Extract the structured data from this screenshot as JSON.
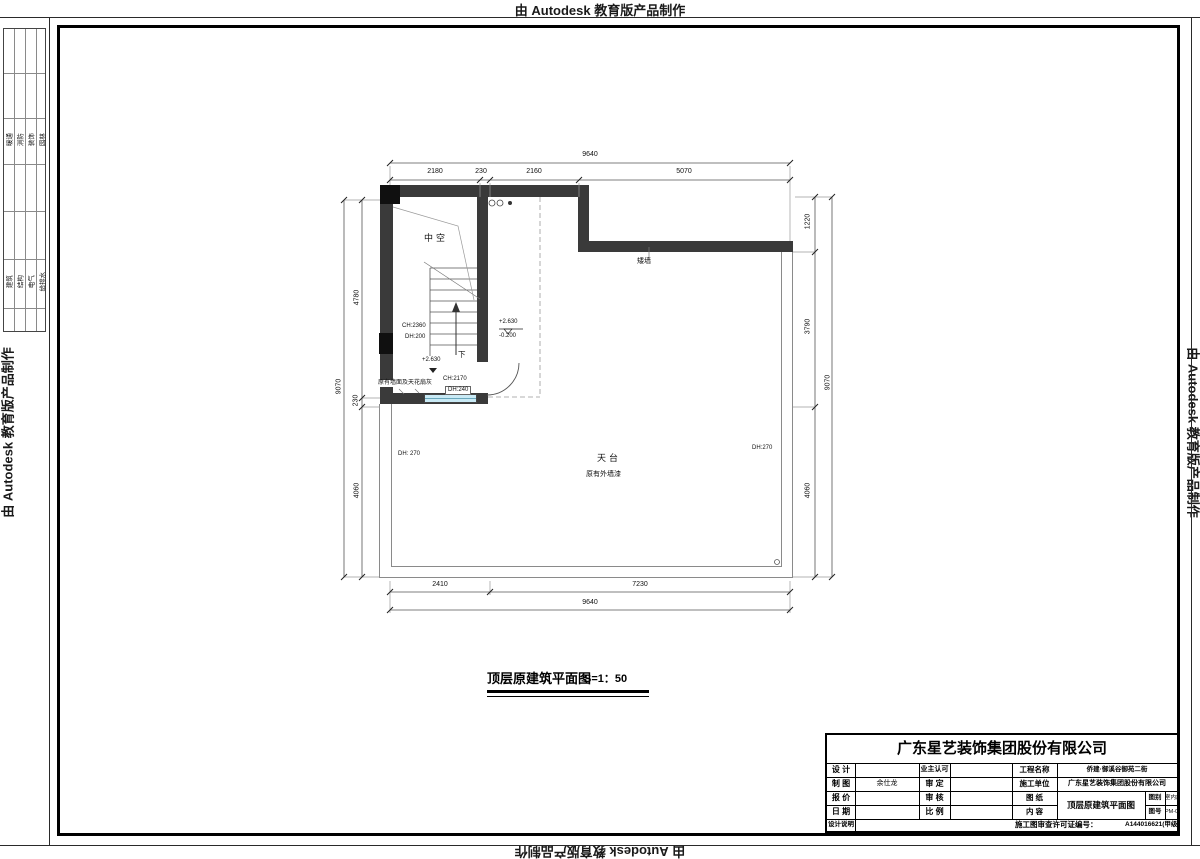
{
  "banner": {
    "text": "由 Autodesk 教育版产品制作"
  },
  "margin_table": {
    "band1": [
      "暖通",
      "消防",
      "装饰",
      "园林"
    ],
    "band2": [
      "建筑",
      "结构",
      "电气",
      "给排水"
    ]
  },
  "plan": {
    "title": "顶层原建筑平面图",
    "scale": "S=1：50",
    "labels": {
      "void": "中空",
      "low_wall": "矮墙",
      "terrace": "天台",
      "terrace_note": "原有外墙漆",
      "wall_note": "原有墙面及天花扇灰",
      "down": "下",
      "ch1": "CH:2360",
      "dh1": "DH:200",
      "ch2": "CH:2170",
      "dh2": "DH:240",
      "dh_left": "DH: 270",
      "dh_right": "DH:270",
      "level_mid": "+2.630",
      "level_top": "+2.630",
      "level_bottom": "-0.200"
    },
    "dims": {
      "top_total": "9640",
      "top_segments": [
        "2180",
        "230",
        "2160",
        "5070"
      ],
      "bottom_segments": [
        "2410",
        "7230"
      ],
      "bottom_total": "9640",
      "left_segments": [
        "4780",
        "230",
        "4060"
      ],
      "left_total": "9070",
      "right_segments": [
        "1220",
        "3790",
        "4060"
      ],
      "right_total": "9070"
    }
  },
  "title_block": {
    "company": "广东星艺装饰集团股份有限公司",
    "design_label": "设 计",
    "draft_label": "制 图",
    "draft_value": "余仕龙",
    "quote_label": "报 价",
    "date_label": "日 期",
    "owner_label": "业主认可",
    "approve_label": "审 定",
    "check_label": "审 核",
    "ratio_label": "比 例",
    "project_label": "工程名称",
    "project_value": "侨建·御溪谷御苑二街",
    "builder_label": "施工单位",
    "builder_value": "广东星艺装饰集团股份有限公司",
    "sheet_label": "图 纸",
    "content_label": "内 容",
    "sheet_value": "顶层原建筑平面图",
    "category_label": "图别",
    "category_value": "室内施",
    "number_label": "图号",
    "number_value": "PM-01",
    "note_label": "设计说明",
    "permit_label": "施工图审查许可证编号：",
    "permit_value": "A144016621(甲级)"
  }
}
